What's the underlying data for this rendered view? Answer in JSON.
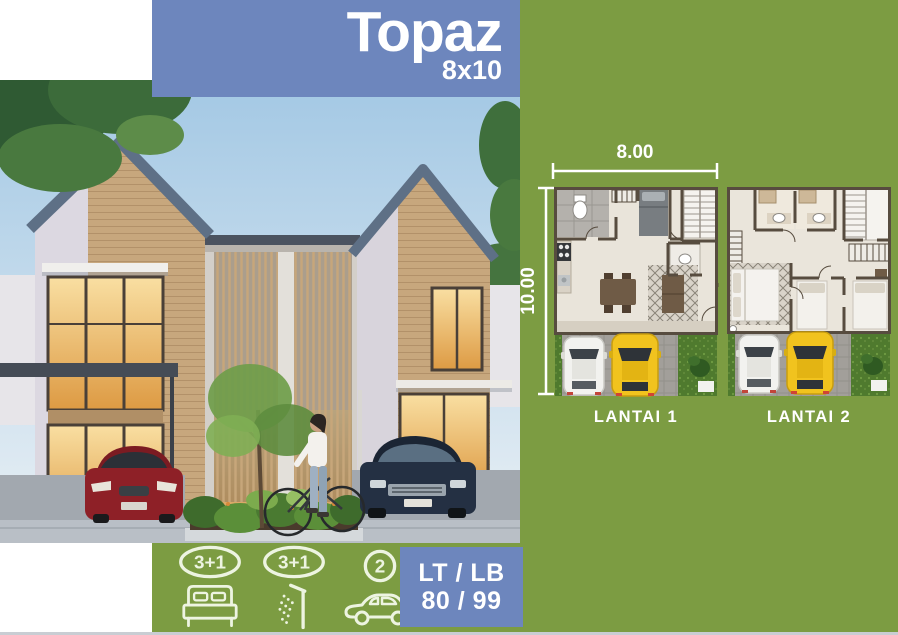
{
  "title": {
    "name": "Topaz",
    "size": "8x10"
  },
  "dimensions": {
    "width": "8.00",
    "depth": "10.00"
  },
  "floorplans": [
    {
      "label": "LANTAI 1"
    },
    {
      "label": "LANTAI 2"
    }
  ],
  "specs": {
    "bedrooms": {
      "count": "3+1",
      "icon": "bed-icon"
    },
    "bathrooms": {
      "count": "3+1",
      "icon": "shower-icon"
    },
    "carport": {
      "count": "2",
      "icon": "car-icon"
    },
    "area": {
      "label": "LT / LB",
      "value": "80 / 99"
    }
  },
  "colors": {
    "green_background": "#7c9c42",
    "blue_accent": "#6d86bd",
    "icon_line": "#edf4e1",
    "plan_wall": "#574c3f",
    "bottom_strip": "#c9cdd3"
  }
}
